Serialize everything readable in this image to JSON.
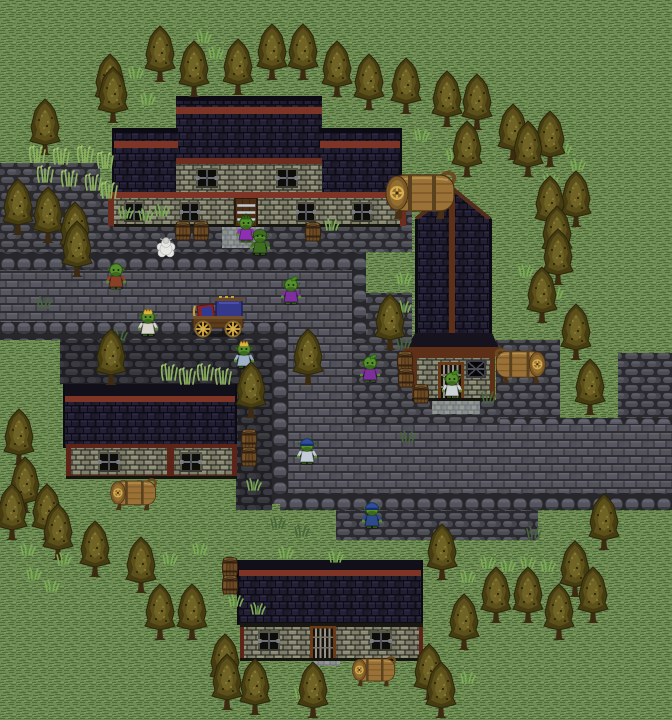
{
  "meta": {
    "width": 672,
    "height": 720,
    "scene": "goblin-village"
  },
  "palette": {
    "grass_base": "#6f8d53",
    "grass_dark": "#4d6c3e",
    "grass_light": "#7fa05e",
    "rock_base": "#2a2a2e",
    "brick": "#565660",
    "roof_navy": "#1e1b2e",
    "trim_red": "#7e3526",
    "wall_stone": "#8b8b76",
    "timber": "#5e3018",
    "tree_olive": "#63571d",
    "barrel_brown": "#6b4a24",
    "cask_tan": "#9a7136",
    "goblin_skin": "#55902c"
  },
  "terrain": [
    {
      "f": "rock",
      "r": [
        0,
        163,
        100,
        89
      ]
    },
    {
      "f": "rock",
      "r": [
        0,
        196,
        412,
        56
      ]
    },
    {
      "f": "bord",
      "r": [
        0,
        252,
        364,
        18
      ]
    },
    {
      "f": "bord",
      "r": [
        348,
        252,
        18,
        88
      ]
    },
    {
      "f": "brick",
      "r": [
        0,
        270,
        352,
        52
      ]
    },
    {
      "f": "bord",
      "r": [
        0,
        322,
        292,
        18
      ]
    },
    {
      "f": "rockdk",
      "r": [
        60,
        340,
        212,
        44
      ]
    },
    {
      "f": "rockdk",
      "r": [
        236,
        384,
        36,
        126
      ]
    },
    {
      "f": "bord",
      "r": [
        272,
        340,
        16,
        164
      ]
    },
    {
      "f": "brick",
      "r": [
        288,
        322,
        64,
        171
      ]
    },
    {
      "f": "rock",
      "r": [
        366,
        293,
        46,
        47
      ]
    },
    {
      "f": "rock",
      "r": [
        352,
        340,
        60,
        97
      ]
    },
    {
      "f": "rock",
      "r": [
        412,
        400,
        124,
        37
      ]
    },
    {
      "f": "rock",
      "r": [
        496,
        340,
        64,
        97
      ]
    },
    {
      "f": "rock",
      "r": [
        618,
        353,
        54,
        70
      ]
    },
    {
      "f": "bord",
      "r": [
        500,
        418,
        172,
        16
      ]
    },
    {
      "f": "brick",
      "r": [
        295,
        424,
        377,
        69
      ]
    },
    {
      "f": "bord",
      "r": [
        280,
        493,
        392,
        17
      ]
    },
    {
      "f": "rock",
      "r": [
        336,
        510,
        202,
        30
      ]
    },
    {
      "f": "mat",
      "r": [
        222,
        222,
        42,
        26
      ]
    },
    {
      "f": "mat",
      "r": [
        432,
        398,
        48,
        16
      ]
    },
    {
      "f": "mat",
      "r": [
        312,
        657,
        28,
        9
      ]
    }
  ],
  "buildings": [
    {
      "name": "inn-north",
      "parts": [
        [
          "r",
          176,
          96,
          146,
          100,
          "roof"
        ],
        [
          "r",
          176,
          96,
          146,
          5,
          "#0c0b14"
        ],
        [
          "r",
          176,
          107,
          146,
          7,
          "#7e3526"
        ],
        [
          "r",
          112,
          128,
          66,
          70,
          "roof"
        ],
        [
          "r",
          112,
          128,
          66,
          5,
          "#0c0b14"
        ],
        [
          "r",
          112,
          141,
          66,
          7,
          "#7e3526"
        ],
        [
          "r",
          112,
          128,
          2,
          70,
          "#0c0b14"
        ],
        [
          "r",
          320,
          128,
          82,
          70,
          "roof"
        ],
        [
          "r",
          320,
          128,
          82,
          5,
          "#0c0b14"
        ],
        [
          "r",
          320,
          141,
          82,
          7,
          "#7e3526"
        ],
        [
          "r",
          400,
          128,
          2,
          70,
          "#0c0b14"
        ],
        [
          "r",
          176,
          158,
          146,
          6,
          "#6f2d1f"
        ],
        [
          "r",
          176,
          164,
          146,
          34,
          "wall"
        ],
        [
          "u",
          "win",
          196,
          168,
          22,
          20
        ],
        [
          "u",
          "win",
          276,
          168,
          22,
          20
        ],
        [
          "r",
          108,
          192,
          298,
          6,
          "#7e3526"
        ],
        [
          "r",
          108,
          196,
          6,
          30,
          "#6f2d1f"
        ],
        [
          "r",
          400,
          196,
          6,
          30,
          "#6f2d1f"
        ],
        [
          "r",
          114,
          198,
          286,
          28,
          "wall"
        ],
        [
          "u",
          "win",
          124,
          202,
          20,
          20
        ],
        [
          "u",
          "win",
          180,
          202,
          20,
          20
        ],
        [
          "u",
          "win",
          296,
          202,
          20,
          20
        ],
        [
          "u",
          "win",
          352,
          202,
          20,
          20
        ],
        [
          "r",
          114,
          224,
          286,
          3,
          "#17170f"
        ],
        [
          "u",
          "doorS",
          234,
          198,
          24,
          28
        ]
      ]
    },
    {
      "name": "tall-house-east",
      "parts": [
        [
          "p",
          "453 188 492 219 415 219",
          "roof"
        ],
        [
          "l",
          453,
          189,
          416,
          219,
          "#54301a",
          4
        ],
        [
          "l",
          453,
          189,
          490,
          219,
          "#54301a",
          4
        ],
        [
          "r",
          415,
          219,
          77,
          114,
          "roof"
        ],
        [
          "r",
          415,
          219,
          3,
          114,
          "#0c0b14"
        ],
        [
          "r",
          489,
          219,
          3,
          114,
          "#0c0b14"
        ],
        [
          "r",
          449,
          196,
          6,
          144,
          "#5e3018"
        ],
        [
          "p",
          "415 333 492 333 500 350 406 350",
          "#16131f"
        ],
        [
          "r",
          404,
          347,
          98,
          7,
          "#5e3018"
        ],
        [
          "r",
          412,
          354,
          82,
          46,
          "wall"
        ],
        [
          "r",
          412,
          354,
          5,
          46,
          "#5e3018"
        ],
        [
          "r",
          490,
          354,
          5,
          46,
          "#5e3018"
        ],
        [
          "r",
          412,
          354,
          82,
          4,
          "#5e3018"
        ],
        [
          "u",
          "winD",
          466,
          360,
          20,
          18
        ],
        [
          "u",
          "doorV",
          438,
          362,
          26,
          38
        ],
        [
          "r",
          412,
          398,
          82,
          3,
          "#15150f"
        ]
      ]
    },
    {
      "name": "house-west",
      "parts": [
        [
          "r",
          63,
          384,
          174,
          14,
          "#100f1a"
        ],
        [
          "r",
          63,
          396,
          174,
          6,
          "#7e3526"
        ],
        [
          "r",
          63,
          402,
          174,
          46,
          "roof"
        ],
        [
          "r",
          63,
          384,
          2,
          64,
          "#0c0b14"
        ],
        [
          "r",
          235,
          384,
          2,
          64,
          "#0c0b14"
        ],
        [
          "r",
          66,
          444,
          171,
          34,
          "#5e2418"
        ],
        [
          "r",
          71,
          448,
          161,
          27,
          "wall"
        ],
        [
          "r",
          167,
          444,
          7,
          34,
          "#5e2418"
        ],
        [
          "u",
          "win",
          98,
          452,
          22,
          20
        ],
        [
          "u",
          "win",
          180,
          452,
          22,
          20
        ],
        [
          "r",
          66,
          476,
          171,
          3,
          "#15150f"
        ]
      ]
    },
    {
      "name": "house-south",
      "parts": [
        [
          "r",
          237,
          560,
          186,
          12,
          "#100f1a"
        ],
        [
          "r",
          237,
          570,
          186,
          6,
          "#7e3526"
        ],
        [
          "r",
          237,
          576,
          186,
          49,
          "roof"
        ],
        [
          "r",
          237,
          560,
          2,
          65,
          "#0c0b14"
        ],
        [
          "r",
          421,
          560,
          2,
          65,
          "#0c0b14"
        ],
        [
          "r",
          240,
          623,
          4,
          37,
          "#5e2418"
        ],
        [
          "r",
          419,
          623,
          4,
          37,
          "#5e2418"
        ],
        [
          "r",
          240,
          623,
          183,
          4,
          "#1a1812"
        ],
        [
          "r",
          244,
          627,
          175,
          31,
          "wall"
        ],
        [
          "u",
          "win",
          258,
          631,
          22,
          20
        ],
        [
          "u",
          "win",
          370,
          631,
          22,
          20
        ],
        [
          "u",
          "doorV",
          310,
          626,
          26,
          33
        ],
        [
          "r",
          240,
          658,
          183,
          3,
          "#15150f"
        ]
      ]
    }
  ],
  "trees": [
    [
      92,
      52
    ],
    [
      142,
      24
    ],
    [
      176,
      39
    ],
    [
      220,
      37
    ],
    [
      254,
      22
    ],
    [
      285,
      22
    ],
    [
      319,
      39
    ],
    [
      351,
      52
    ],
    [
      388,
      56
    ],
    [
      95,
      65
    ],
    [
      27,
      97
    ],
    [
      0,
      177
    ],
    [
      30,
      185
    ],
    [
      57,
      200
    ],
    [
      59,
      219
    ],
    [
      429,
      69
    ],
    [
      459,
      72
    ],
    [
      495,
      102
    ],
    [
      449,
      119
    ],
    [
      510,
      119
    ],
    [
      532,
      109
    ],
    [
      558,
      169
    ],
    [
      532,
      174
    ],
    [
      539,
      204
    ],
    [
      540,
      227
    ],
    [
      524,
      265
    ],
    [
      558,
      302
    ],
    [
      572,
      357
    ],
    [
      372,
      292
    ],
    [
      233,
      360
    ],
    [
      93,
      327
    ],
    [
      290,
      327
    ],
    [
      1,
      407
    ],
    [
      7,
      455
    ],
    [
      29,
      482
    ],
    [
      40,
      502
    ],
    [
      -6,
      482
    ],
    [
      77,
      519
    ],
    [
      123,
      535
    ],
    [
      142,
      582
    ],
    [
      174,
      582
    ],
    [
      207,
      632
    ],
    [
      209,
      652
    ],
    [
      237,
      657
    ],
    [
      295,
      660
    ],
    [
      411,
      642
    ],
    [
      423,
      660
    ],
    [
      446,
      592
    ],
    [
      478,
      565
    ],
    [
      510,
      565
    ],
    [
      541,
      582
    ],
    [
      557,
      539
    ],
    [
      575,
      565
    ],
    [
      586,
      492
    ],
    [
      424,
      522
    ]
  ],
  "tufts": [
    [
      128,
      66
    ],
    [
      196,
      30
    ],
    [
      208,
      46
    ],
    [
      140,
      92
    ],
    [
      118,
      206
    ],
    [
      138,
      208
    ],
    [
      154,
      204
    ],
    [
      324,
      218
    ],
    [
      414,
      128
    ],
    [
      446,
      148
    ],
    [
      556,
      142
    ],
    [
      570,
      158
    ],
    [
      543,
      173
    ],
    [
      396,
      272
    ],
    [
      396,
      300
    ],
    [
      518,
      264
    ],
    [
      548,
      286
    ],
    [
      246,
      478
    ],
    [
      20,
      543
    ],
    [
      56,
      552
    ],
    [
      162,
      552
    ],
    [
      192,
      542
    ],
    [
      26,
      567
    ],
    [
      44,
      579
    ],
    [
      228,
      594
    ],
    [
      250,
      602
    ],
    [
      278,
      546
    ],
    [
      328,
      550
    ],
    [
      480,
      556
    ],
    [
      500,
      559
    ],
    [
      520,
      556
    ],
    [
      540,
      559
    ],
    [
      460,
      570
    ],
    [
      460,
      671
    ],
    [
      294,
      686
    ]
  ],
  "talls": [
    [
      28,
      146
    ],
    [
      52,
      148
    ],
    [
      76,
      146
    ],
    [
      96,
      152
    ],
    [
      36,
      166
    ],
    [
      60,
      170
    ],
    [
      84,
      174
    ],
    [
      100,
      182
    ],
    [
      160,
      364
    ],
    [
      178,
      368
    ],
    [
      196,
      364
    ],
    [
      214,
      368
    ]
  ],
  "weeds": [
    [
      36,
      296
    ],
    [
      112,
      328
    ],
    [
      270,
      516
    ],
    [
      294,
      524
    ],
    [
      434,
      528
    ],
    [
      526,
      526
    ],
    [
      400,
      430
    ],
    [
      481,
      390
    ],
    [
      396,
      336
    ]
  ],
  "barrels": [
    [
      174,
      220
    ],
    [
      192,
      220
    ],
    [
      304,
      221
    ],
    [
      396,
      350
    ],
    [
      397,
      367
    ],
    [
      412,
      383
    ],
    [
      240,
      428
    ],
    [
      240,
      446
    ],
    [
      221,
      556
    ],
    [
      221,
      574
    ]
  ],
  "casks": [
    {
      "x": 382,
      "y": 169,
      "s": 1,
      "flip": false
    },
    {
      "x": 492,
      "y": 347,
      "s": 0.72,
      "flip": true
    },
    {
      "x": 108,
      "y": 477,
      "s": 0.66,
      "flip": false
    },
    {
      "x": 350,
      "y": 655,
      "s": 0.62,
      "flip": false
    }
  ],
  "cart": {
    "x": 189,
    "y": 296
  },
  "sheep": {
    "x": 156,
    "y": 236
  },
  "goblins": [
    {
      "x": 236,
      "y": 215,
      "c": "#8c2fb0",
      "hat": "mohawk"
    },
    {
      "x": 250,
      "y": 228,
      "c": "#3f6d22",
      "hat": "hood"
    },
    {
      "x": 106,
      "y": 262,
      "c": "#8a4026",
      "hat": "none"
    },
    {
      "x": 138,
      "y": 309,
      "c": "#d8d4cc",
      "hat": "crown"
    },
    {
      "x": 281,
      "y": 277,
      "c": "#7d2f9e",
      "hat": "leaf"
    },
    {
      "x": 234,
      "y": 341,
      "c": "#9fb3c8",
      "hat": "crown"
    },
    {
      "x": 442,
      "y": 371,
      "c": "#cdd2d6",
      "hat": "leaf"
    },
    {
      "x": 360,
      "y": 355,
      "c": "#7d2f9e",
      "hat": "leaf"
    },
    {
      "x": 362,
      "y": 501,
      "c": "#2c4a8c",
      "hat": "cap"
    },
    {
      "x": 297,
      "y": 437,
      "c": "#c3cdd8",
      "hat": "cap"
    }
  ]
}
